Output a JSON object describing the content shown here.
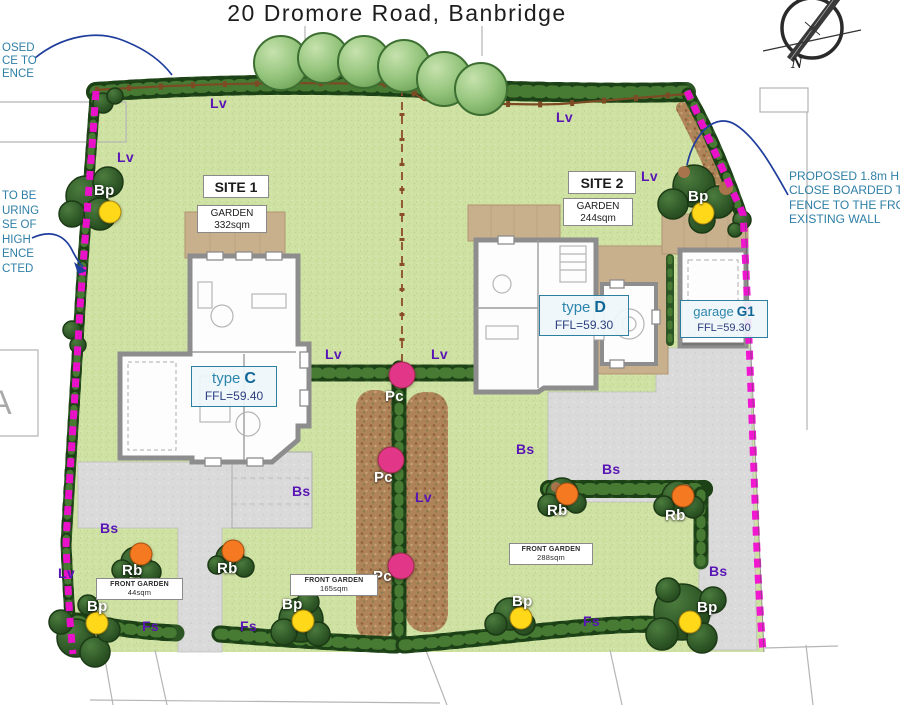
{
  "title": "20 Dromore Road, Banbridge",
  "compass": {
    "north_label": "N"
  },
  "neighbor_plot_label": "A",
  "annotations": {
    "top_left": "OSED\nCE TO\nENCE",
    "mid_left": "TO BE\nURING\nSE OF\nHIGH\nENCE\nCTED",
    "right": "PROPOSED 1.8m HIGH\nCLOSE BOARDED TIM\nFENCE TO THE FRONT\nEXISTING WALL"
  },
  "sites": {
    "site1": {
      "name": "SITE 1",
      "garden_label": "GARDEN",
      "garden_area": "332sqm"
    },
    "site2": {
      "name": "SITE 2",
      "garden_label": "GARDEN",
      "garden_area": "244sqm"
    }
  },
  "buildings": {
    "type_c": {
      "prefix": "type",
      "letter": "C",
      "ffl": "FFL=59.40"
    },
    "type_d": {
      "prefix": "type",
      "letter": "D",
      "ffl": "FFL=59.30"
    },
    "garage_g1": {
      "prefix": "garage",
      "letter": "G1",
      "ffl": "FFL=59.30"
    }
  },
  "front_gardens": [
    {
      "label": "FRONT GARDEN",
      "area": "44sqm"
    },
    {
      "label": "FRONT GARDEN",
      "area": "165sqm"
    },
    {
      "label": "FRONT GARDEN",
      "area": "288sqm"
    }
  ],
  "planting": {
    "legend": {
      "Lv": {
        "text_color": "#5a16b5",
        "dot_color": null
      },
      "Bp": {
        "text_color": "#ffffff",
        "dot_color": "#ffd919",
        "dot_size": 21
      },
      "Pc": {
        "text_color": "#ffffff",
        "dot_color": "#e23688",
        "dot_size": 25
      },
      "Rb": {
        "text_color": "#ffffff",
        "dot_color": "#f47920",
        "dot_size": 21
      },
      "Bs": {
        "text_color": "#5a16b5",
        "dot_color": null
      },
      "Fs": {
        "text_color": "#5a16b5",
        "dot_color": null
      }
    },
    "markers": [
      {
        "code": "Lv",
        "x": 210,
        "y": 95
      },
      {
        "code": "Lv",
        "x": 556,
        "y": 109
      },
      {
        "code": "Lv",
        "x": 117,
        "y": 149
      },
      {
        "code": "Lv",
        "x": 641,
        "y": 168
      },
      {
        "code": "Lv",
        "x": 325,
        "y": 346
      },
      {
        "code": "Lv",
        "x": 431,
        "y": 346
      },
      {
        "code": "Lv",
        "x": 415,
        "y": 489
      },
      {
        "code": "Lv",
        "x": 58,
        "y": 565
      },
      {
        "code": "Bp",
        "x": 94,
        "y": 182,
        "dot": {
          "x": 110,
          "y": 212
        }
      },
      {
        "code": "Bp",
        "x": 688,
        "y": 188,
        "dot": {
          "x": 703,
          "y": 213
        }
      },
      {
        "code": "Bp",
        "x": 87,
        "y": 598,
        "dot": {
          "x": 97,
          "y": 623
        }
      },
      {
        "code": "Bp",
        "x": 282,
        "y": 596,
        "dot": {
          "x": 303,
          "y": 621
        }
      },
      {
        "code": "Bp",
        "x": 512,
        "y": 593,
        "dot": {
          "x": 521,
          "y": 618
        }
      },
      {
        "code": "Bp",
        "x": 697,
        "y": 599,
        "dot": {
          "x": 690,
          "y": 622
        }
      },
      {
        "code": "Pc",
        "x": 385,
        "y": 388,
        "dot": {
          "x": 402,
          "y": 375
        }
      },
      {
        "code": "Pc",
        "x": 374,
        "y": 469,
        "dot": {
          "x": 391,
          "y": 460
        }
      },
      {
        "code": "Pc",
        "x": 373,
        "y": 568,
        "dot": {
          "x": 401,
          "y": 566
        }
      },
      {
        "code": "Rb",
        "x": 122,
        "y": 562,
        "dot": {
          "x": 141,
          "y": 554
        }
      },
      {
        "code": "Rb",
        "x": 217,
        "y": 560,
        "dot": {
          "x": 233,
          "y": 551
        }
      },
      {
        "code": "Rb",
        "x": 547,
        "y": 502,
        "dot": {
          "x": 567,
          "y": 494
        }
      },
      {
        "code": "Rb",
        "x": 665,
        "y": 507,
        "dot": {
          "x": 683,
          "y": 496
        }
      },
      {
        "code": "Bs",
        "x": 292,
        "y": 483
      },
      {
        "code": "Bs",
        "x": 100,
        "y": 520
      },
      {
        "code": "Bs",
        "x": 516,
        "y": 441
      },
      {
        "code": "Bs",
        "x": 602,
        "y": 461
      },
      {
        "code": "Bs",
        "x": 709,
        "y": 563
      },
      {
        "code": "Fs",
        "x": 142,
        "y": 618
      },
      {
        "code": "Fs",
        "x": 240,
        "y": 618
      },
      {
        "code": "Fs",
        "x": 583,
        "y": 613
      }
    ]
  },
  "colors": {
    "boundary_fence": "#f20dd2",
    "hedge": "#2c5624",
    "lawn": "#cfe2a3",
    "annotation_text": "#2f7fa6",
    "leader_line": "#1f3d9c",
    "house_label_accent": "#2d86ad"
  }
}
